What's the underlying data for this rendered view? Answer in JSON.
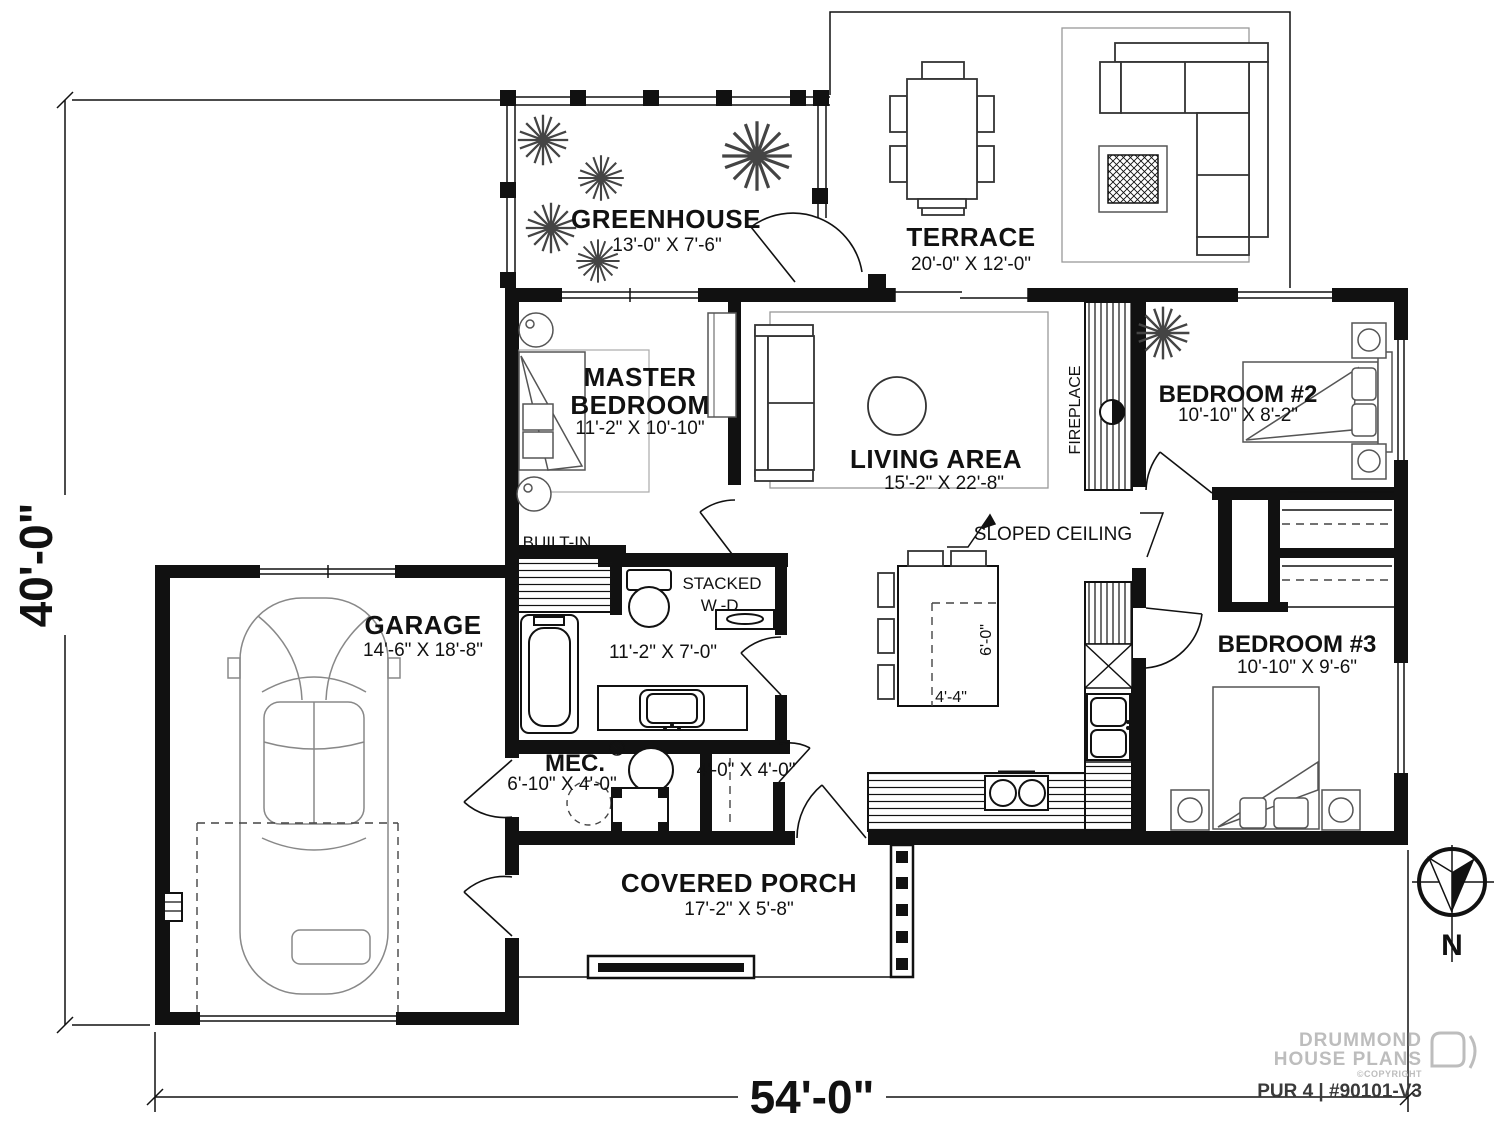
{
  "plan": {
    "rooms": [
      {
        "name": "GREENHOUSE",
        "dims": "13'-0\" X 7'-6\""
      },
      {
        "name": "TERRACE",
        "dims": "20'-0\" X 12'-0\""
      },
      {
        "name_line1": "MASTER",
        "name_line2": "BEDROOM",
        "dims": "11'-2\" X 10'-10\""
      },
      {
        "name": "LIVING AREA",
        "dims": "15'-2\" X 22'-8\""
      },
      {
        "name": "BEDROOM #2",
        "dims": "10'-10\" X 8'-2\""
      },
      {
        "name": "BEDROOM #3",
        "dims": "10'-10\" X 9'-6\""
      },
      {
        "name": "GARAGE",
        "dims": "14'-6\" X 18'-8\""
      },
      {
        "name": "MEC.",
        "dims": "6'-10\" X 4'-0\""
      },
      {
        "name": "COVERED PORCH",
        "dims": "17'-2\" X 5'-8\""
      }
    ],
    "annotations": {
      "built_in": "BUILT-IN",
      "stacked_line1": "STACKED",
      "stacked_line2": "W.-D.",
      "bath_dims": "11'-2\" X 7'-0\"",
      "closet_dims": "4'-0\" X 4'-0\"",
      "island_depth": "6'-0\"",
      "island_width": "4'-4\"",
      "sloped_ceiling": "SLOPED CEILING",
      "fireplace": "FIREPLACE"
    },
    "overall": {
      "width_label": "54'-0\"",
      "height_label": "40'-0\""
    },
    "compass": {
      "north_label": "N"
    },
    "title_block": {
      "brand_line1": "DRUMMOND",
      "brand_line2": "HOUSE PLANS",
      "copyright_note": "©COPYRIGHT",
      "plan_number": "PUR 4 | #90101-V3"
    }
  }
}
